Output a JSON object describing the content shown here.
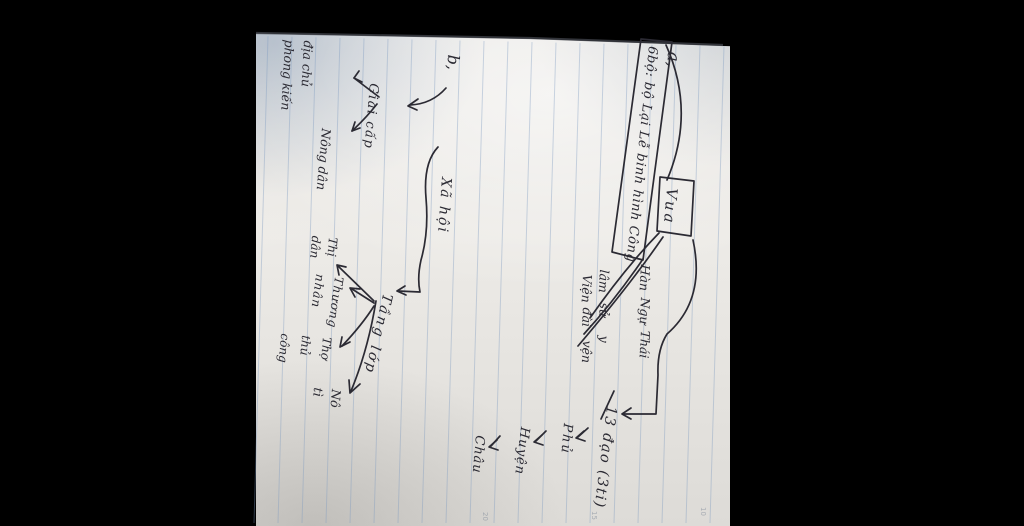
{
  "photo_meta": {
    "ink_color": "#2b2a33",
    "ruled_line_color": "#7d9ac0",
    "paper_color": "#eae7e3",
    "desk_color": "#c2cdd8",
    "background_color": "#000000"
  },
  "section_a": {
    "label": "a,",
    "ministries_box": "6bộ: bộ Lại Lễ binh hình Công",
    "king": "Vua",
    "institutions": [
      [
        "Hàn",
        "lâm",
        "Viện"
      ],
      [
        "Ngự",
        "sử",
        "đài"
      ],
      [
        "Thái",
        "y",
        "vện"
      ]
    ],
    "provinces": "13 đạo (3ti)",
    "admin_chain": [
      "Phủ",
      "Huyện",
      "Châu"
    ]
  },
  "section_b": {
    "label": "b,",
    "society": "Xã hội",
    "class_group": {
      "label": "Giai cấp",
      "landlord": [
        "địa chủ",
        "phong kiến"
      ],
      "farmer": "Nông dân"
    },
    "stratum_group": {
      "label": "Tầng lớp",
      "children": [
        [
          "Thị",
          "dân"
        ],
        [
          "Thương",
          "nhân"
        ],
        [
          "Thợ",
          "thủ",
          "công"
        ],
        [
          "Nô",
          "tì"
        ]
      ]
    }
  },
  "margin_numbers": [
    "20",
    "15",
    "10"
  ]
}
